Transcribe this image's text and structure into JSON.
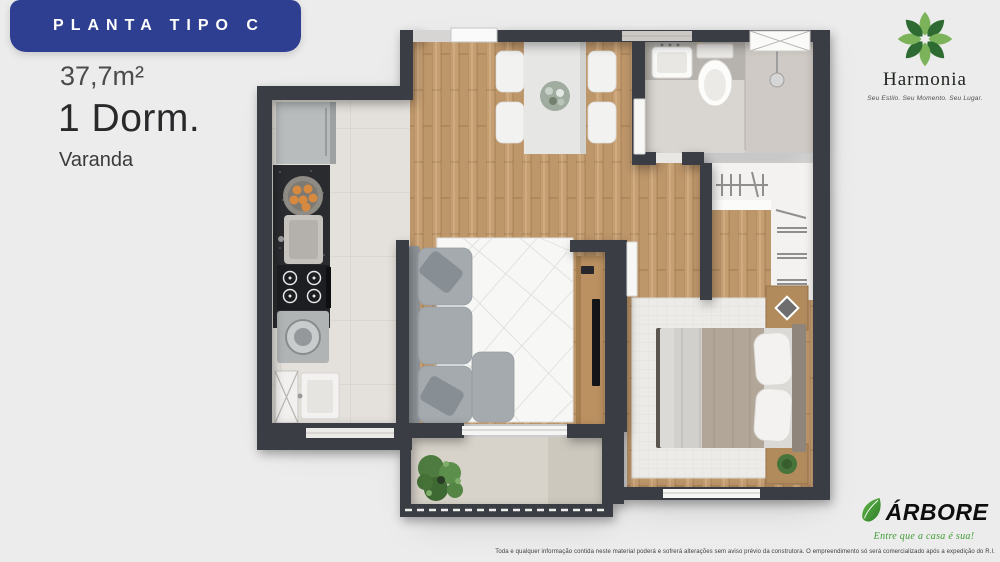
{
  "banner": {
    "label": "PLANTA TIPO C"
  },
  "specs": {
    "area": "37,7m²",
    "bedrooms": "1 Dorm.",
    "feature": "Varanda"
  },
  "brand": {
    "name": "Harmonia",
    "tagline": "Seu Estilo. Seu Momento. Seu Lugar."
  },
  "developer": {
    "name": "ÁRBORE",
    "slogan": "Entre que a casa é sua!"
  },
  "footer": {
    "disclaimer": "Toda e qualquer informação contida neste material poderá e sofrerá alterações sem aviso prévio da construtora. O empreendimento só será comercializado após a expedição do R.I."
  },
  "palette": {
    "banner_blue": "#2e3f92",
    "wall_charcoal": "#3a3d43",
    "brand_green_dark": "#2e6b33",
    "brand_green_light": "#7cb35a",
    "arbore_green": "#3f9c35",
    "wood_floor": "#c59e72",
    "kitchen_tile": "#e4e0db",
    "bath_floor": "#d9d5d0",
    "balcony_floor": "#d8d3ca",
    "sofa_gray": "#a4aaae"
  }
}
